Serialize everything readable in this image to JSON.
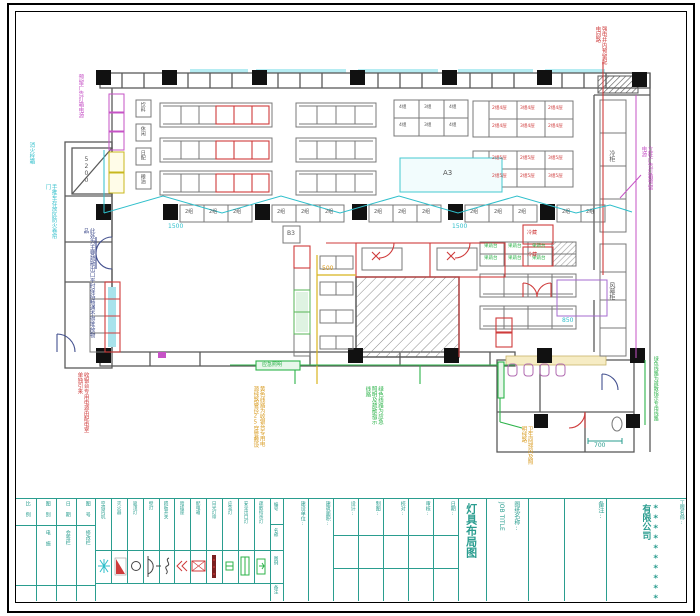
{
  "sheet": {
    "type": "CAD floor plan drawing",
    "bg": "#ffffff"
  },
  "colors": {
    "walls": "#5a5a5a",
    "columns": "#111111",
    "red_lines": "#cf3b3b",
    "magenta_lines": "#c653c6",
    "cyan_lines": "#2fbfcb",
    "green_lines": "#2db34a",
    "yellow_lines": "#d8b41e",
    "titleblock_teal": "#2a9d8f",
    "hatch": "#8a8a8a"
  },
  "annotations": {
    "tl_magenta": "预留广告灯箱电源",
    "left_cyan_top": "消火栓箱",
    "left_cyan_mid": "手推车存放区防火卷帘门",
    "left_blue": "此处为主要疏散出口平时保持畅通不得堆放物品",
    "left_red_bottom": "收银台专用电源由配电室单独引来",
    "top_right_red": "强电井内预留配电回路",
    "right_magenta": "立柱广告灯箱预留电源",
    "bottom_orange": "黄色线路为收银台专用电源线路管径25穿管敷设",
    "bottom_green": "绿色线路为应急照明及疏散指示线路",
    "bottom_orange2": "卫生间排风及照明线路",
    "right_green": "绿色线路为疏散指示专用线路"
  },
  "dims": {
    "d1500a": "1500",
    "d1500b": "1500",
    "d500": "500",
    "d700": "700",
    "d850": "850",
    "ramp": "5200"
  },
  "labels": {
    "checkout": "2组",
    "corridor_top": "冷柜",
    "corridor_bottom": "风幕柜",
    "red_box": "冷藏",
    "cyan_box": "A3",
    "small_box": "B3",
    "emergency": "应急照明",
    "green_cell": "果蔬台",
    "left_boxes": [
      "饮料",
      "休闲",
      "日配",
      "粮油"
    ],
    "g1": [
      "4组",
      "3组",
      "4组",
      "4组",
      "3组",
      "4组"
    ],
    "g2": [
      "2组4层",
      "3组4层",
      "2组4层",
      "2组4层",
      "3组4层",
      "2组4层"
    ],
    "g3": [
      "2组5层",
      "2组5层",
      "3组5层",
      "2组5层",
      "2组5层",
      "3组5层"
    ]
  },
  "titleblock": {
    "a_cols": [
      {
        "top": "比 例",
        "bottom": ""
      },
      {
        "top": "图 别",
        "bottom": "电 施"
      },
      {
        "top": "日 期",
        "bottom": "会签栏"
      },
      {
        "top": "图 号",
        "bottom": "修改栏"
      }
    ],
    "c_labels": [
      "建设单位:",
      "建筑面积:",
      "设计:",
      "制图:",
      "校对:",
      "审核:",
      "日期:"
    ],
    "legend_header": [
      "编号",
      "名称",
      "图例",
      "备注"
    ],
    "drawing_title": "灯具布局图",
    "job_title_label": "图纸名称:",
    "job_title_en": "JOB TITLE",
    "remark_label": "备注:",
    "project_label": "工程名称:",
    "company": "**********有限公司"
  },
  "legend": {
    "items": [
      {
        "label": "空调内机"
      },
      {
        "label": "灭火器"
      },
      {
        "label": "吸顶灯"
      },
      {
        "label": "壁灯"
      },
      {
        "label": "跷板开关"
      },
      {
        "label": "暗插座"
      },
      {
        "label": "配电箱"
      },
      {
        "label": "日光灯带"
      },
      {
        "label": "应急灯"
      },
      {
        "label": "安全出口灯"
      },
      {
        "label": "疏散指示灯"
      }
    ]
  }
}
